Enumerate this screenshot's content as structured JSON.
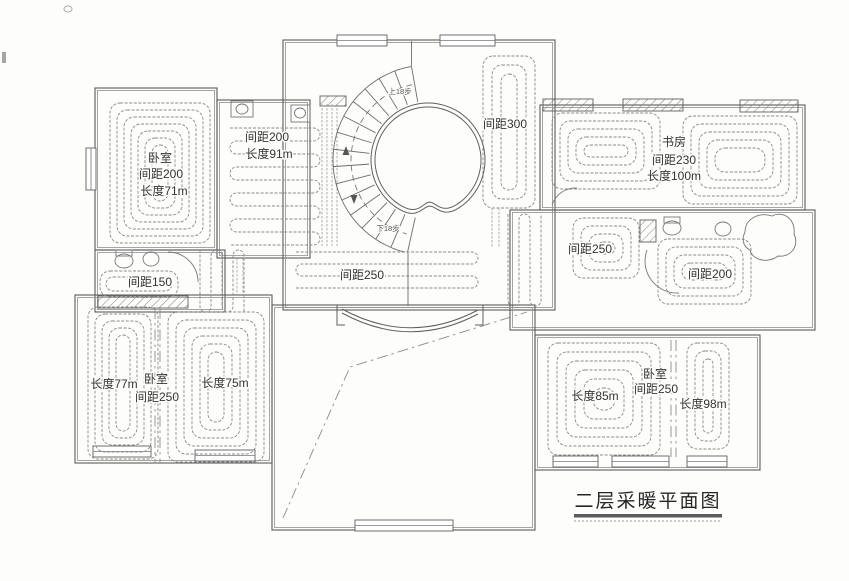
{
  "title": {
    "text": "二层采暖平面图"
  },
  "stair": {
    "up_label": {
      "text": "上18步",
      "x": 400,
      "y": 94
    },
    "down_label": {
      "text": "下18步",
      "x": 388,
      "y": 231
    }
  },
  "labels": [
    {
      "name": "bedroom-nw-name",
      "text": "卧室",
      "x": 160,
      "y": 162
    },
    {
      "name": "bedroom-nw-spacing",
      "text": "间距200",
      "x": 161,
      "y": 178
    },
    {
      "name": "bedroom-nw-length",
      "text": "长度71m",
      "x": 164,
      "y": 195
    },
    {
      "name": "corridor-spacing",
      "text": "间距200",
      "x": 267,
      "y": 141
    },
    {
      "name": "corridor-length",
      "text": "长度91m",
      "x": 269,
      "y": 158
    },
    {
      "name": "hall-east-spacing",
      "text": "间距300",
      "x": 505,
      "y": 128
    },
    {
      "name": "study-name",
      "text": "书房",
      "x": 674,
      "y": 146
    },
    {
      "name": "study-spacing",
      "text": "间距230",
      "x": 674,
      "y": 164
    },
    {
      "name": "study-length",
      "text": "长度100m",
      "x": 674,
      "y": 180
    },
    {
      "name": "bath-west-spacing",
      "text": "间距150",
      "x": 150,
      "y": 286
    },
    {
      "name": "hall-south-spacing",
      "text": "间距250",
      "x": 362,
      "y": 279
    },
    {
      "name": "closet-east-spacing",
      "text": "间距250",
      "x": 590,
      "y": 253
    },
    {
      "name": "bath-east-spacing",
      "text": "间距200",
      "x": 710,
      "y": 278
    },
    {
      "name": "bedroom-sw-length-left",
      "text": "长度77m",
      "x": 114,
      "y": 388
    },
    {
      "name": "bedroom-sw-name",
      "text": "卧室",
      "x": 156,
      "y": 383
    },
    {
      "name": "bedroom-sw-spacing",
      "text": "间距250",
      "x": 157,
      "y": 401
    },
    {
      "name": "bedroom-sw-length-right",
      "text": "长度75m",
      "x": 225,
      "y": 387
    },
    {
      "name": "bedroom-se-length-left",
      "text": "长度85m",
      "x": 595,
      "y": 400
    },
    {
      "name": "bedroom-se-name",
      "text": "卧室",
      "x": 655,
      "y": 378
    },
    {
      "name": "bedroom-se-spacing",
      "text": "间距250",
      "x": 656,
      "y": 393
    },
    {
      "name": "bedroom-se-length-right",
      "text": "长度98m",
      "x": 703,
      "y": 408
    }
  ],
  "colors": {
    "wall": "#5a5a5a",
    "pipe": "#8a8a8a",
    "text": "#333333",
    "background": "#fdfdfc"
  }
}
